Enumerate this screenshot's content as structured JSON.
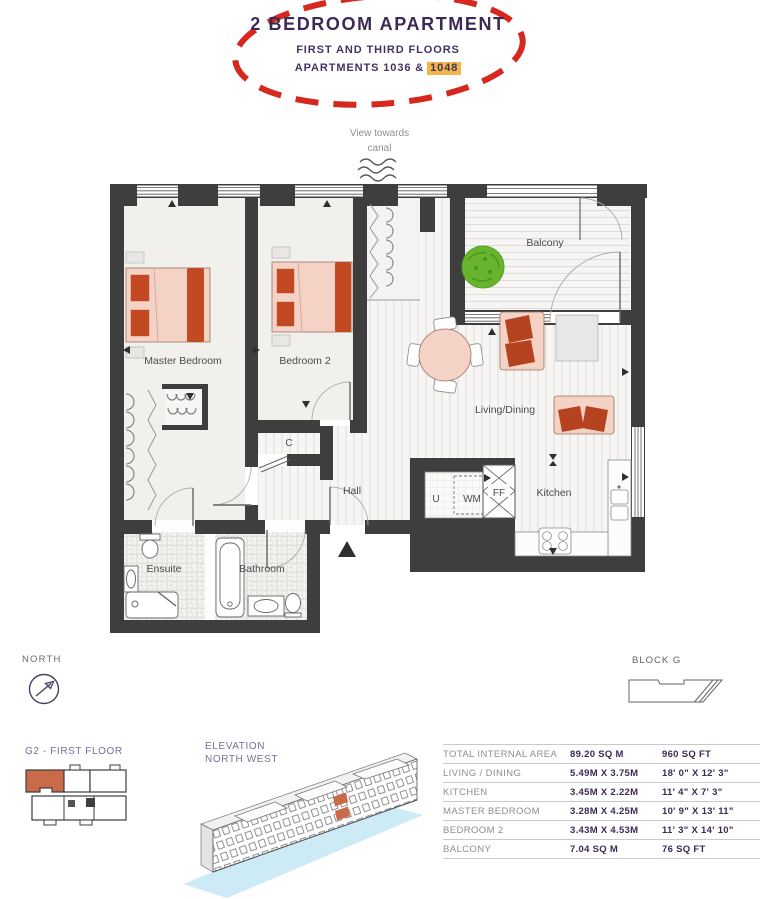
{
  "header": {
    "title": "2 BEDROOM APARTMENT",
    "subtitle": "FIRST AND THIRD FLOORS",
    "apartments_prefix": "APARTMENTS 1036 &",
    "apartments_highlight": "1048"
  },
  "view_note": {
    "line1": "View towards",
    "line2": "canal"
  },
  "plan": {
    "rooms": {
      "master_bedroom": "Master Bedroom",
      "bedroom2": "Bedroom 2",
      "balcony": "Balcony",
      "living_dining": "Living/Dining",
      "kitchen": "Kitchen",
      "hall": "Hall",
      "ensuite": "Ensuite",
      "bathroom": "Bathroom",
      "cupboard": "C",
      "utility": "U",
      "washing_machine": "WM",
      "fridge_freezer": "FF"
    }
  },
  "compass": {
    "label": "NORTH"
  },
  "block": {
    "label": "BLOCK G"
  },
  "key_plan": {
    "title": "G2 - FIRST FLOOR"
  },
  "elevation": {
    "line1": "ELEVATION",
    "line2": "NORTH WEST"
  },
  "dimensions_table": {
    "rows": [
      {
        "label": "TOTAL INTERNAL AREA",
        "metric": "89.20 SQ M",
        "imperial": "960 SQ FT"
      },
      {
        "label": "LIVING / DINING",
        "metric": "5.49M X 3.75M",
        "imperial": "18' 0\" X 12' 3\""
      },
      {
        "label": "KITCHEN",
        "metric": "3.45M X 2.22M",
        "imperial": "11' 4\" X 7' 3\""
      },
      {
        "label": "MASTER BEDROOM",
        "metric": "3.28M X 4.25M",
        "imperial": "10' 9\" X 13' 11\""
      },
      {
        "label": "BEDROOM 2",
        "metric": "3.43M X 4.53M",
        "imperial": "11' 3\" X 14' 10\""
      },
      {
        "label": "BALCONY",
        "metric": "7.04 SQ M",
        "imperial": "76 SQ FT"
      }
    ]
  },
  "colors": {
    "accent_red": "#d6281e",
    "highlight_yellow": "#f2b648",
    "heading_purple": "#3b2a55",
    "unit_orange": "#c96a49",
    "wall_dark": "#3e3e3e",
    "canal_blue": "#cdeaf7"
  }
}
